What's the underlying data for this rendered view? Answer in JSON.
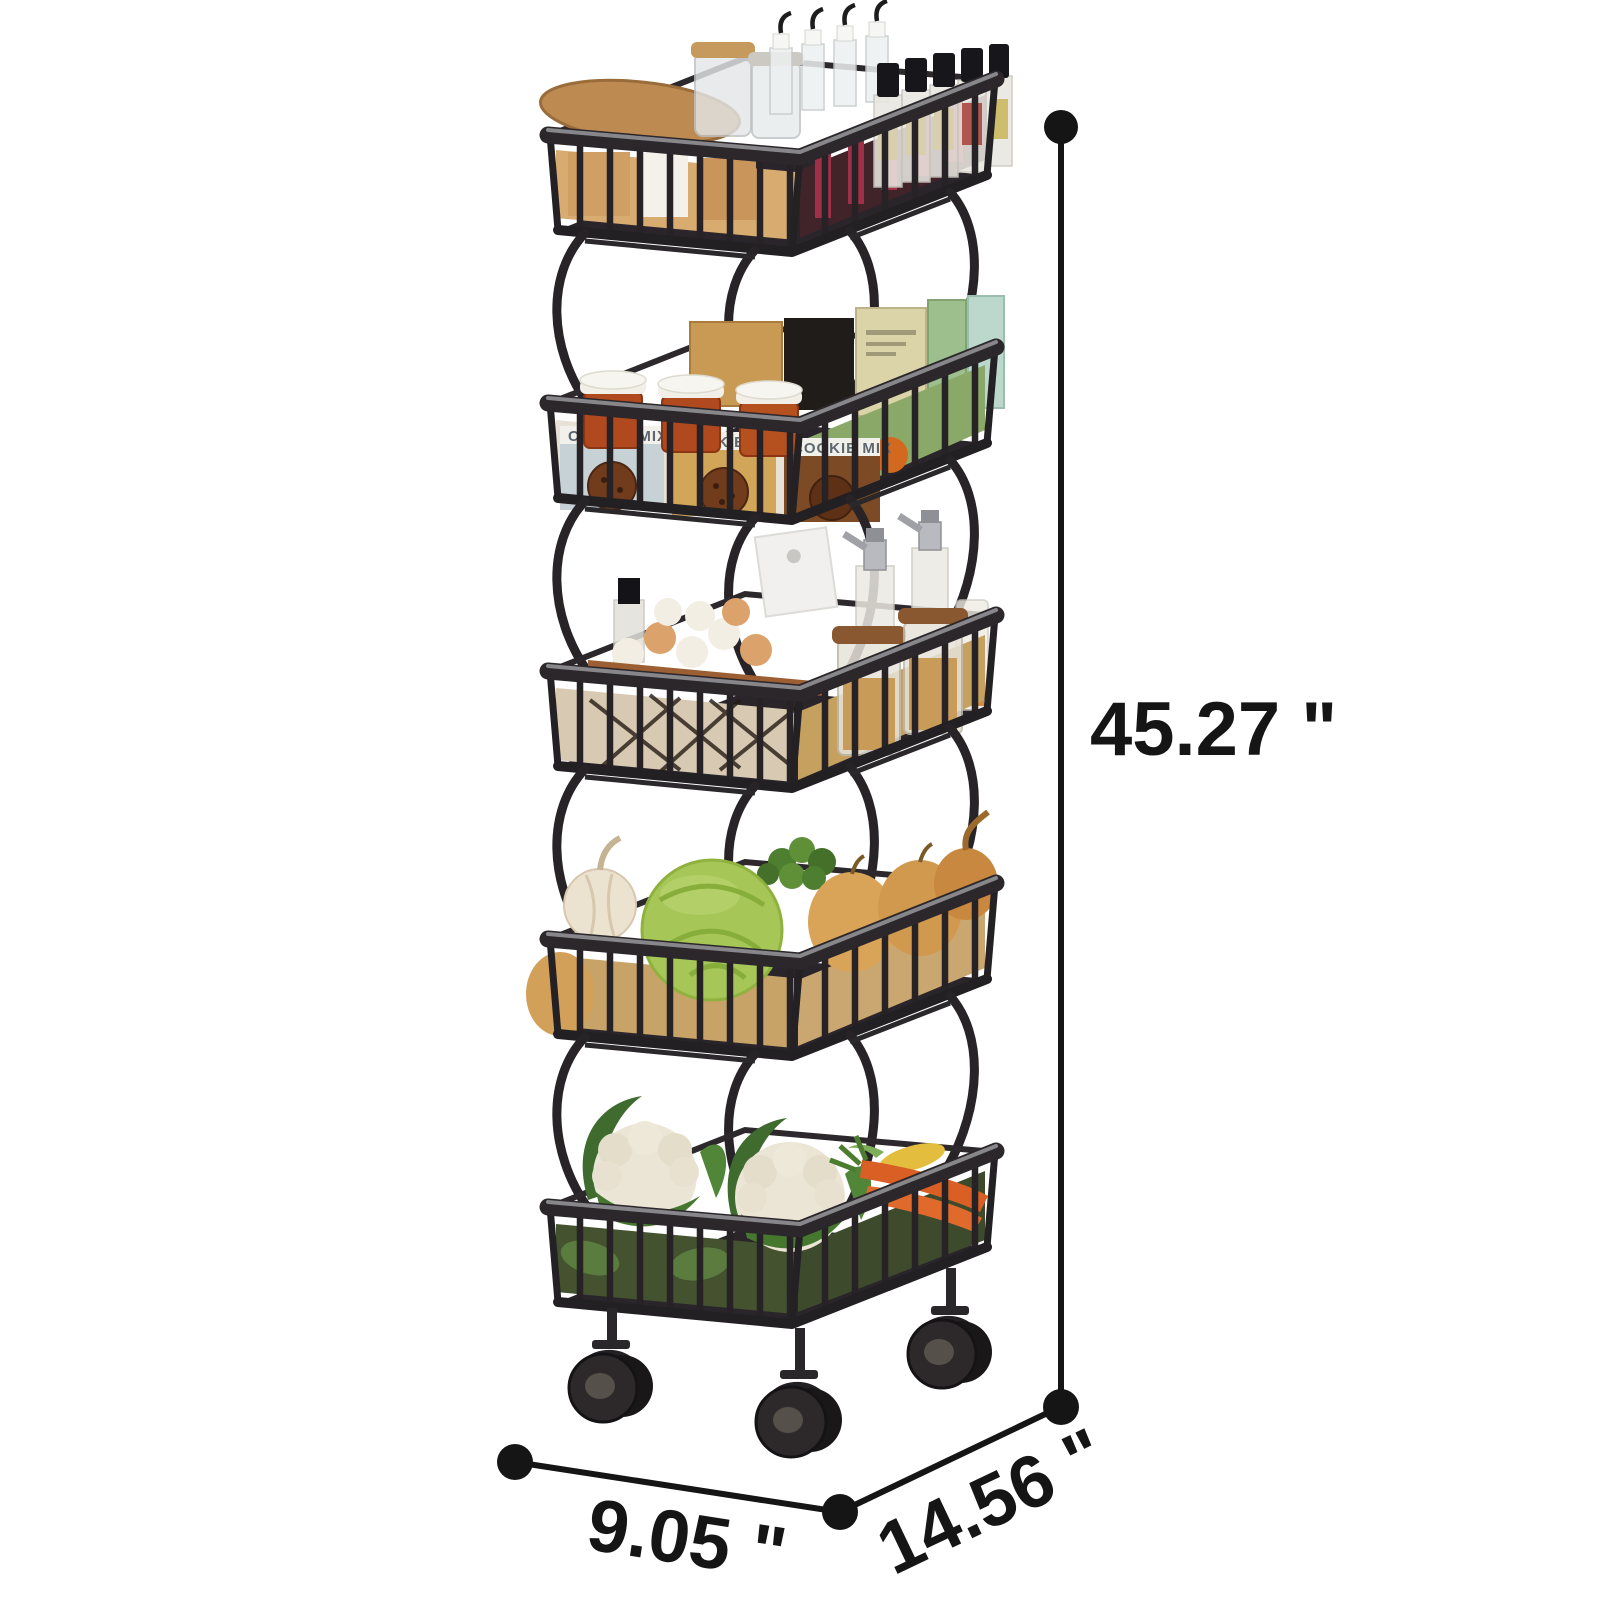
{
  "diagram": {
    "background": "#ffffff",
    "dimension_color": "#151515",
    "labels": {
      "height": "45.27 \"",
      "width": "9.05 \"",
      "depth": "14.56 \""
    }
  },
  "product": {
    "type": "5-tier-wire-basket-rolling-cart",
    "frame_color": "#262226",
    "tier_count": 5,
    "tiers": [
      {
        "index": 1,
        "contents": "cutting-board, spice-jars, hook-bottles, oil-bottles"
      },
      {
        "index": 2,
        "contents": "jam-jars, cookie-mix-cartons, food-boxes"
      },
      {
        "index": 3,
        "contents": "egg-basket, grain-jars, oil-dispensers, white-box"
      },
      {
        "index": 4,
        "contents": "garlic, cabbage, pears, parsley, onion"
      },
      {
        "index": 5,
        "contents": "cauliflowers, carrots, corn"
      }
    ],
    "packaging_text": "COOKIE MIX",
    "visible_casters": 3
  }
}
